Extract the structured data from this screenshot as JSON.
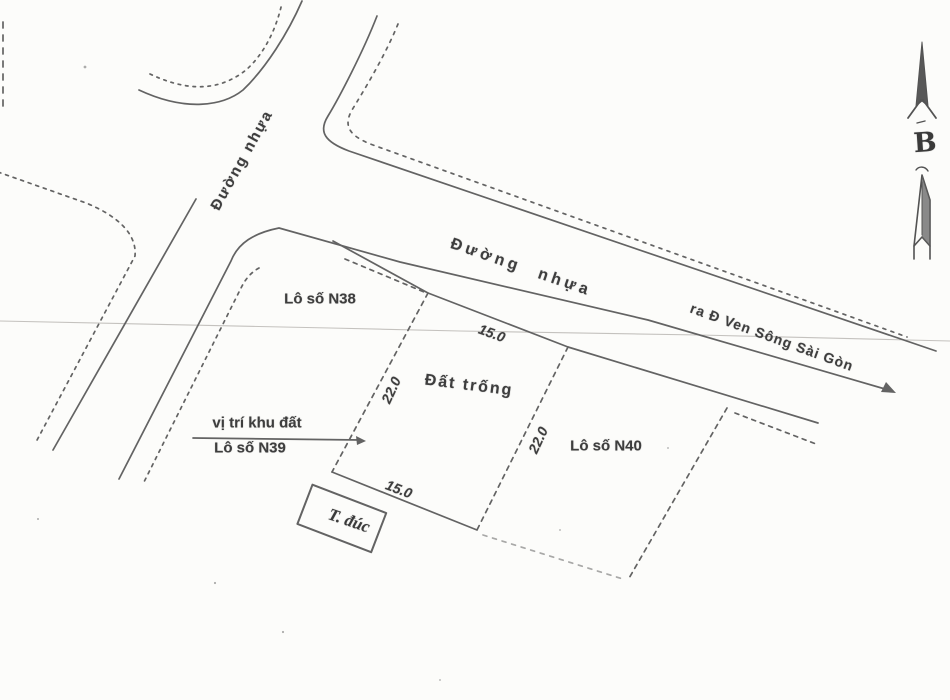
{
  "map": {
    "roads": {
      "left_label": "Đường nhựa",
      "main_label": "Đường nhựa",
      "direction_label": "ra Đ Ven Sông Sài Gòn"
    },
    "plots": {
      "n38_label": "Lô số N38",
      "n39_pointer_line1": "vị trí khu đất",
      "n39_pointer_line2": "Lô số N39",
      "n40_label": "Lô số N40",
      "center_label": "Đất trống"
    },
    "dimensions": {
      "front_width": "15.0",
      "back_width": "15.0",
      "left_depth": "22.0",
      "right_depth": "22.0"
    },
    "structures": {
      "t_duc_label": "T. đúc"
    },
    "compass": {
      "north_letter": "B"
    },
    "colors": {
      "ink": "#4f4f4f",
      "paper": "#fcfcfa",
      "artifact": "#b5b2ae"
    }
  }
}
